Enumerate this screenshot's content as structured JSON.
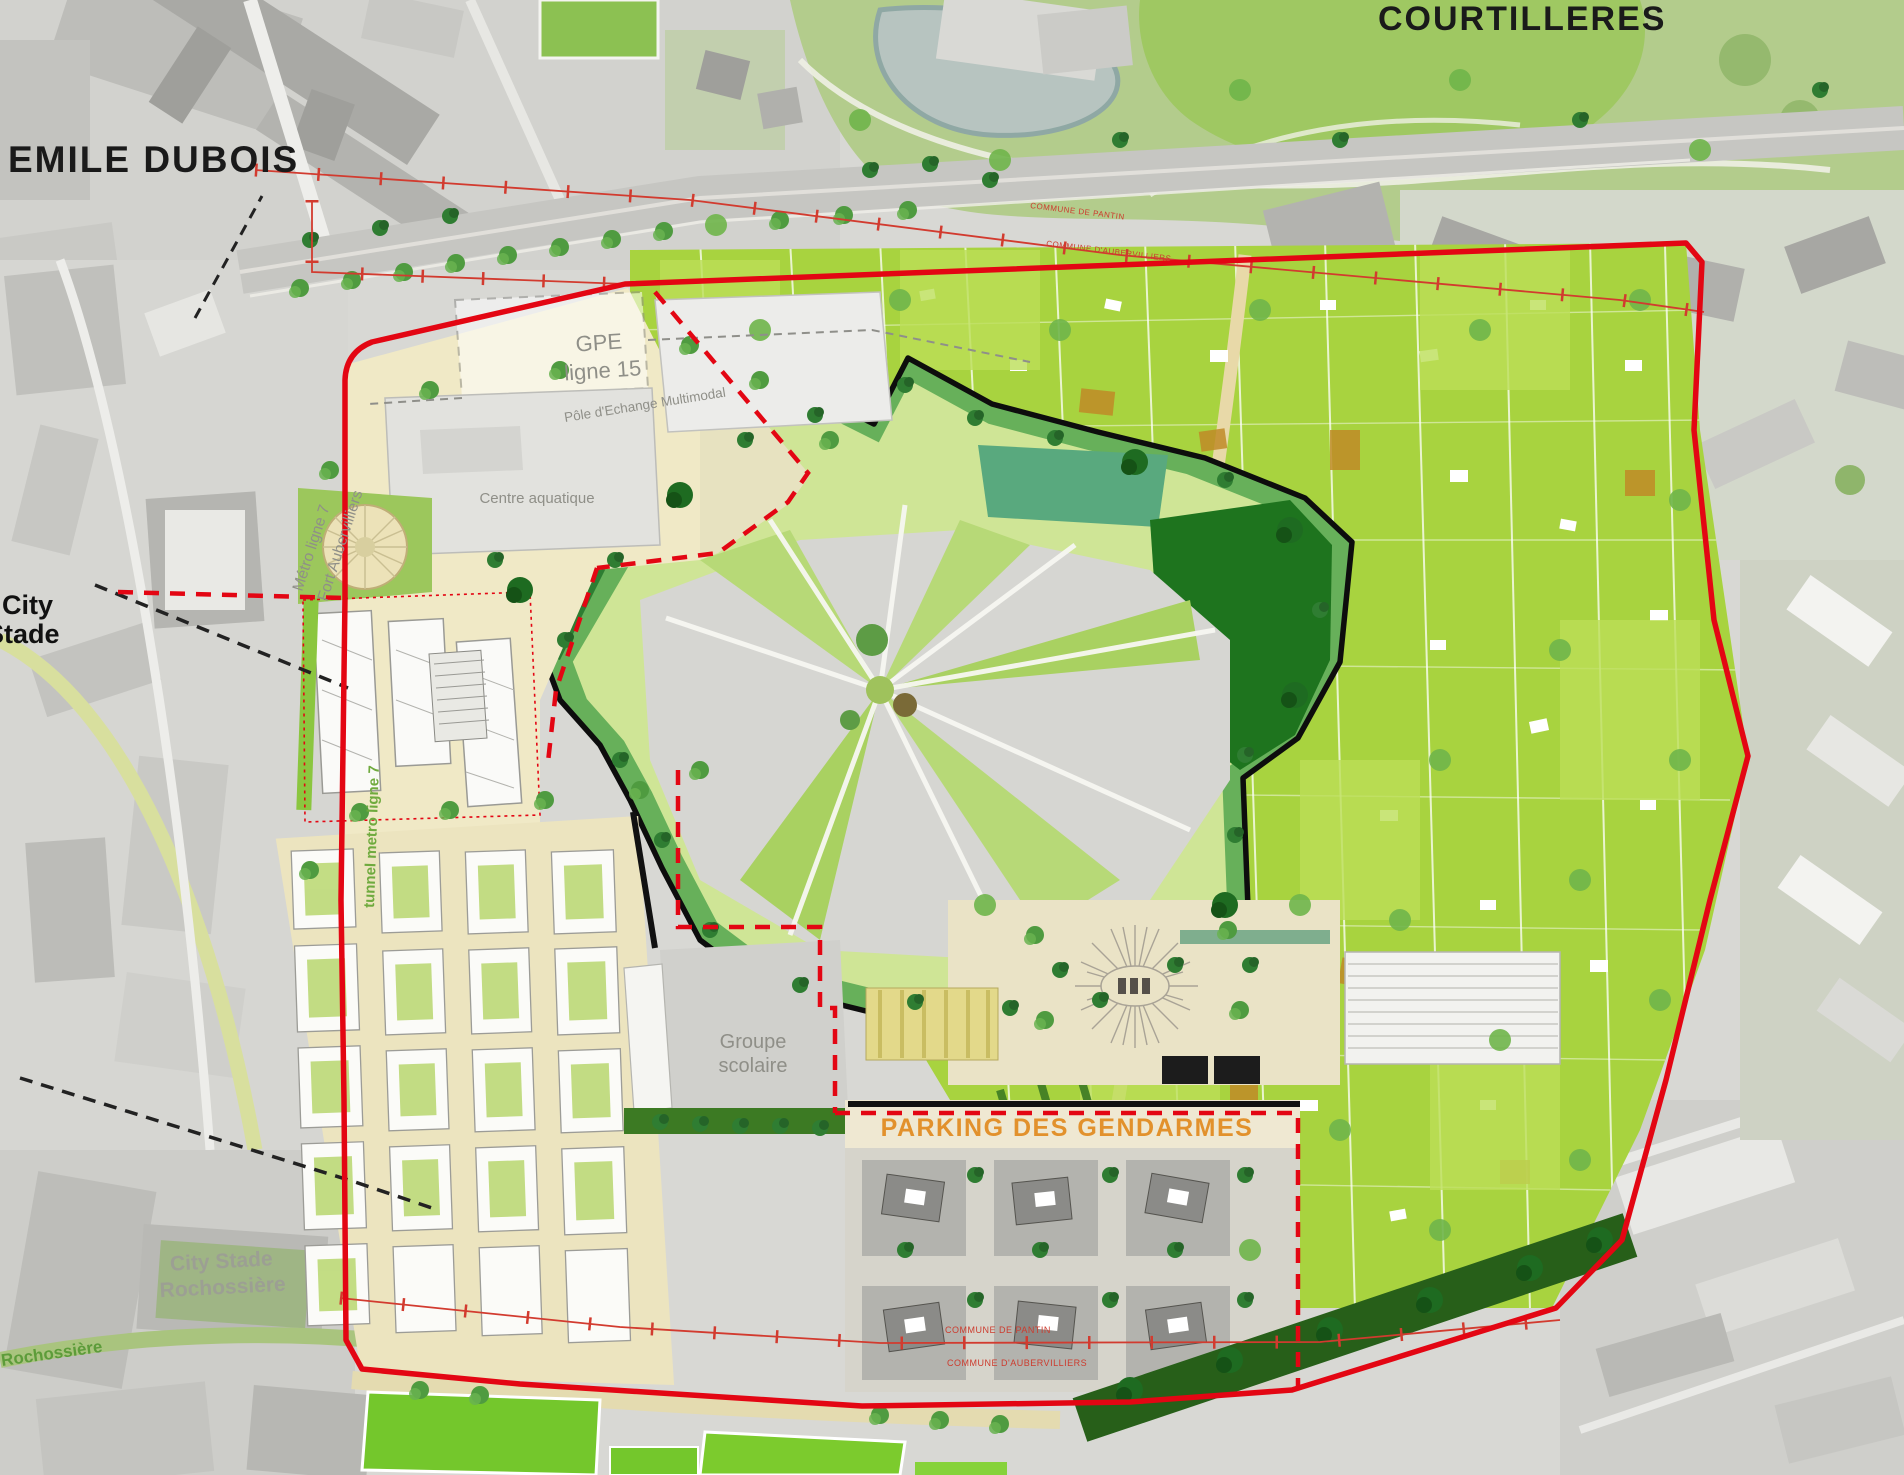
{
  "map_labels": {
    "district_nw": "EMILE DUBOIS",
    "district_ne": "COURTILLERES",
    "gpe_line1": "GPE",
    "gpe_line2": "ligne 15",
    "pole_echange": "Pôle d'Echange Multimodal",
    "metro_line1": "Métro ligne 7",
    "metro_line2": "Fort Aubervilliers",
    "centre_aquatique": "Centre aquatique",
    "city_stade_line1": "City",
    "city_stade_line2": "Stade",
    "tunnel_metro": "tunnel metro ligne 7",
    "groupe_scolaire_line1": "Groupe",
    "groupe_scolaire_line2": "scolaire",
    "parking_gendarmes": "PARKING DES GENDARMES",
    "city_stade_south_line1": "City Stade",
    "city_stade_south_line2": "Rochossière",
    "street_rochossiere": "Rochossière",
    "commune_pantin": "COMMUNE DE PANTIN",
    "commune_aubervilliers": "COMMUNE D'AUBERVILLIERS"
  },
  "colors": {
    "site_boundary": "#e30613",
    "zone_boundary_dashed": "#e30613",
    "commune_line": "#d23b2f",
    "parking_label": "#e2912c",
    "district_label": "#1a1a1a",
    "facility_label": "#8f8f88",
    "tunnel_label": "#6faa3e",
    "allotment_green": "#a8d33f",
    "fort_moat_green": "#67b05a",
    "park_green": "#b3cc8c",
    "sports_field_green": "#76c82e"
  }
}
